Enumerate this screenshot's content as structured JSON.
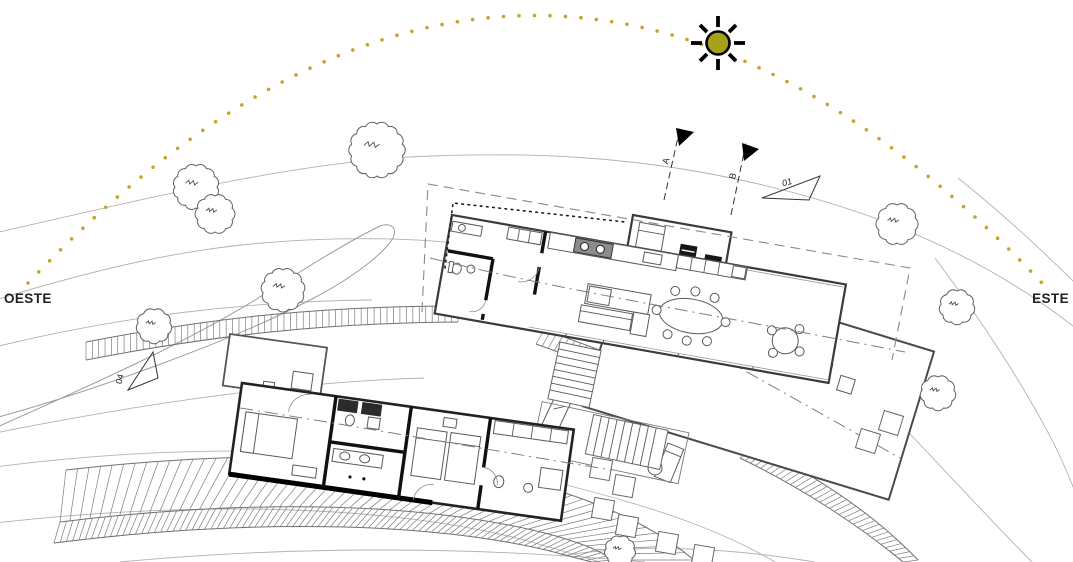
{
  "labels": {
    "west": "OESTE",
    "east": "ESTE"
  },
  "markers": {
    "section_a": "A",
    "section_b": "B",
    "view_01": "01",
    "view_04": "04"
  },
  "colors": {
    "sun_fill": "#A7A119",
    "sun_stroke": "#000000",
    "arc_dots": "#C9A22B",
    "ink": "#222222"
  }
}
